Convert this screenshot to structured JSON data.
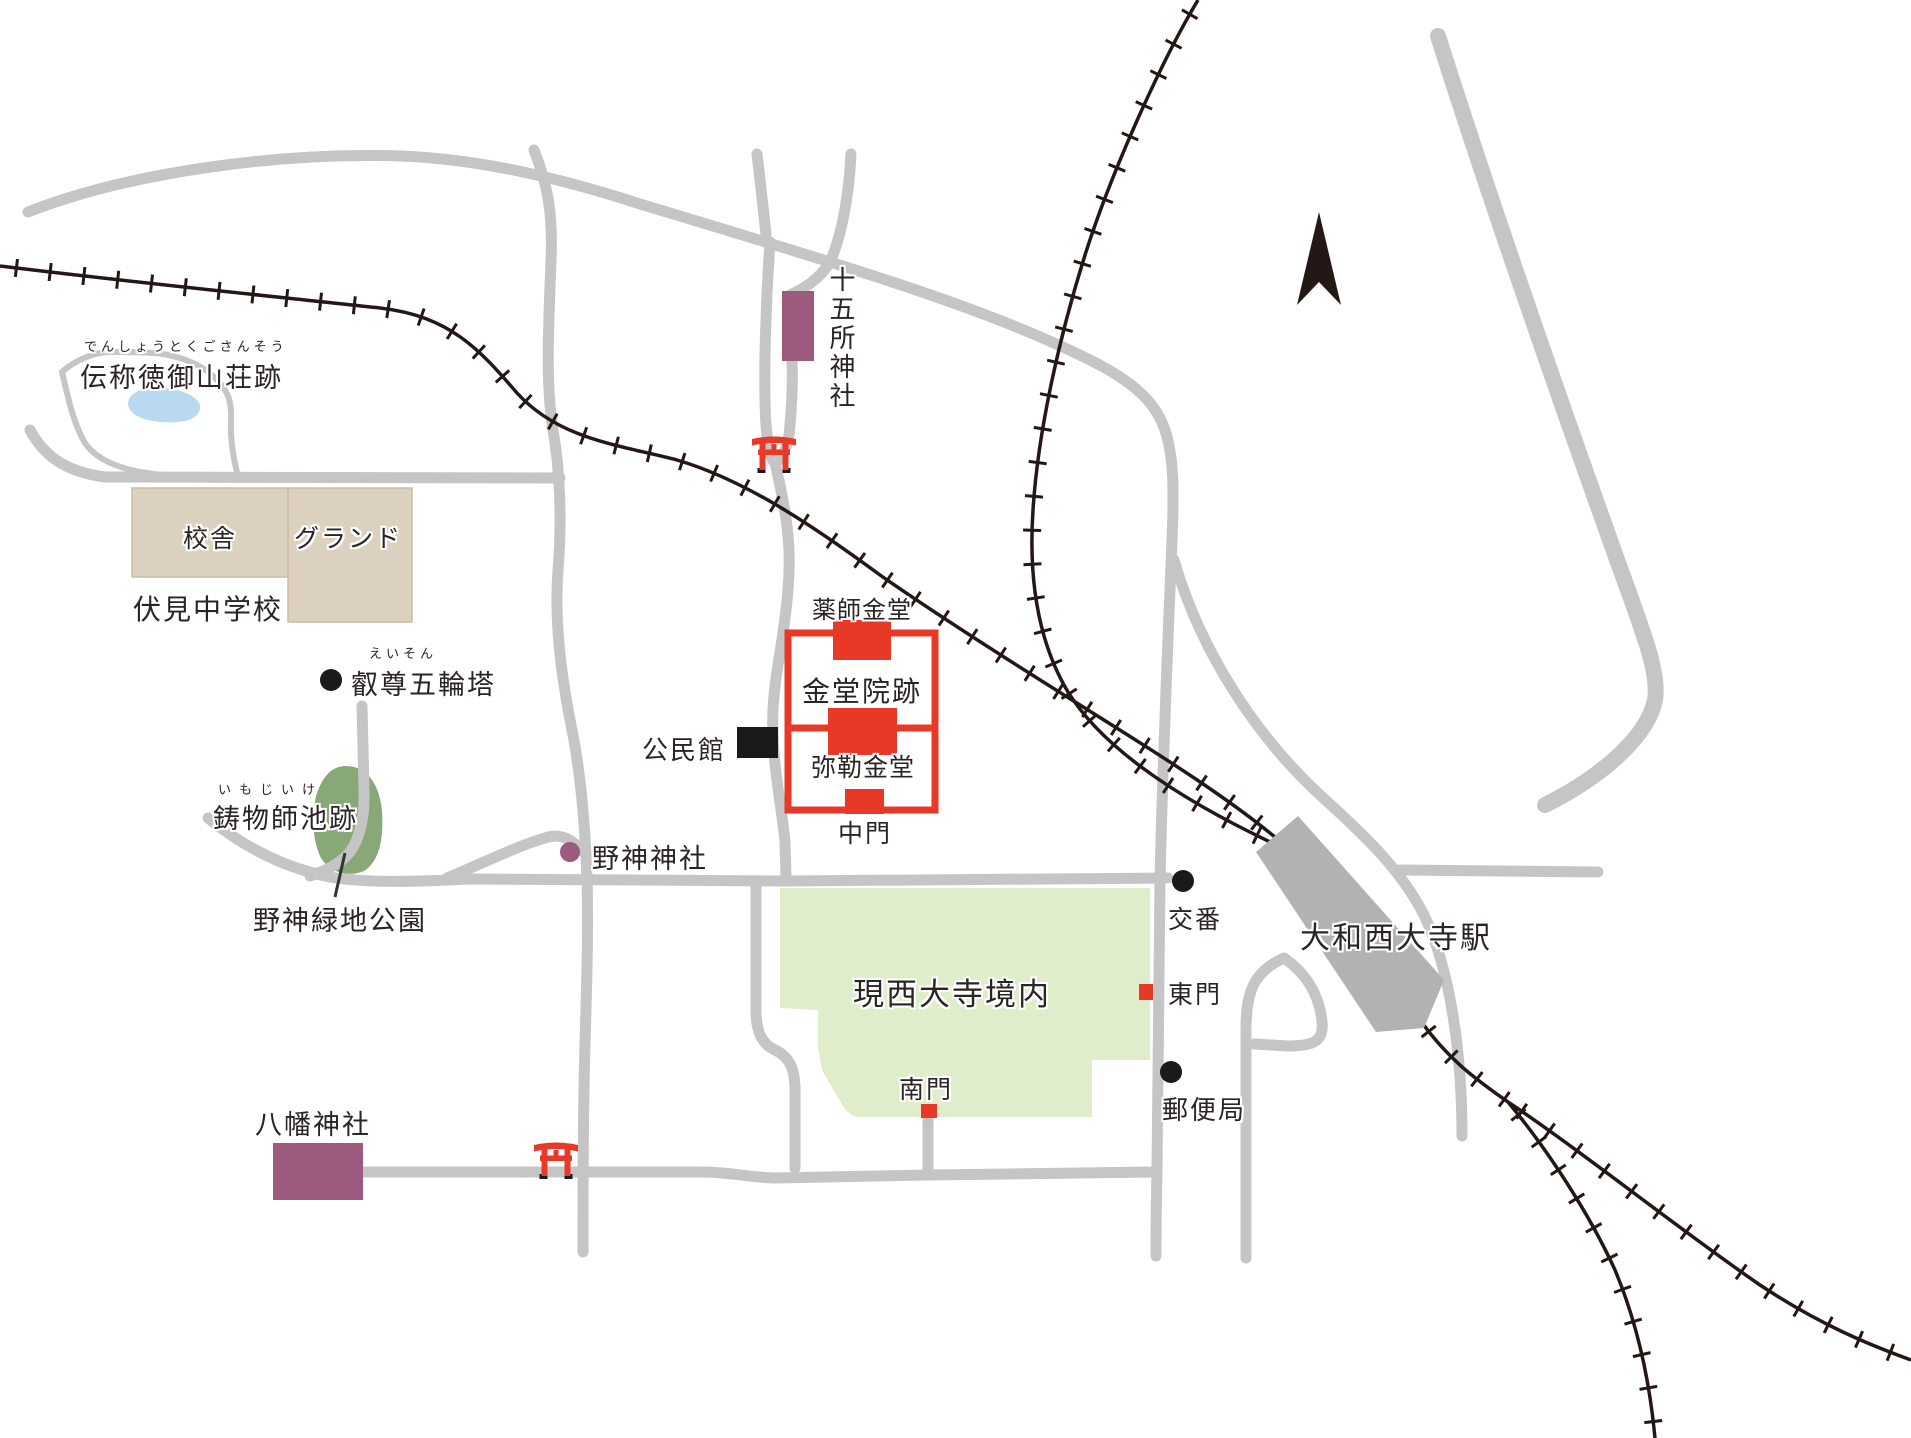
{
  "colors": {
    "road": "#c5c5c6",
    "railway": "#231815",
    "station_fill": "#b2b2b2",
    "temple_red": "#e73828",
    "shrine_purple": "#9c5b7e",
    "park_green": "#88a878",
    "precinct_green": "#e0edca",
    "school_tan": "#dbd1be",
    "pond_blue": "#b8d9ef",
    "text": "#2a2422"
  },
  "places": {
    "densho": {
      "furigana": "でんしょうとくごさんそう",
      "label": "伝称徳御山荘跡"
    },
    "school": {
      "building": "校舎",
      "ground": "グランド",
      "name": "伏見中学校"
    },
    "eison": {
      "furigana": "えいそん",
      "label": "叡尊五輪塔"
    },
    "imojiike": {
      "furigana": "いもじいけ",
      "label": "鋳物師池跡"
    },
    "nogami_park": {
      "label": "野神緑地公園"
    },
    "nogami_shrine": {
      "label": "野神神社"
    },
    "jugosho_shrine": {
      "label": "十五所神社"
    },
    "kondoin": {
      "yakushi": "薬師金堂",
      "label": "金堂院跡",
      "miroku": "弥勒金堂",
      "chumon": "中門"
    },
    "kominkan": {
      "label": "公民館"
    },
    "saidaiji": {
      "label": "現西大寺境内",
      "south_gate": "南門",
      "east_gate": "東門"
    },
    "koban": {
      "label": "交番"
    },
    "post_office": {
      "label": "郵便局"
    },
    "station": {
      "label": "大和西大寺駅"
    },
    "hachiman_shrine": {
      "label": "八幡神社"
    }
  }
}
